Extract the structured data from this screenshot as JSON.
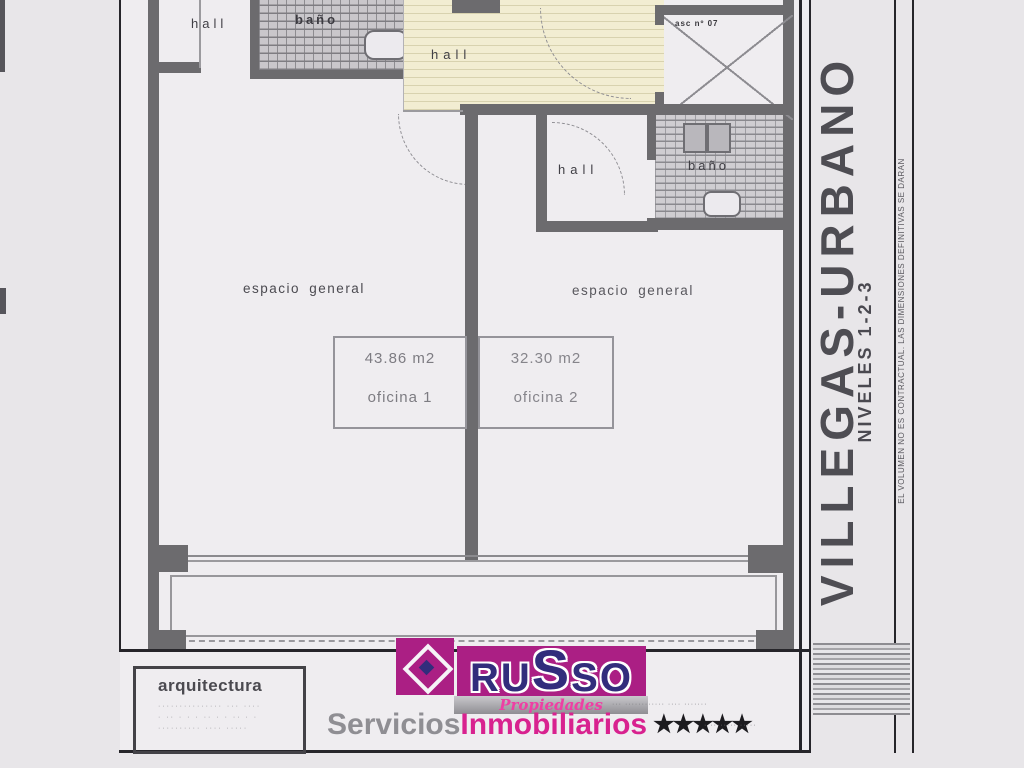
{
  "plan": {
    "labels": {
      "hall_top_left": "hall",
      "bath_top": "baño",
      "hall_main": "hall",
      "elevator": "asc nº 07",
      "hall_mid": "hall",
      "bath_mid": "baño",
      "space_left": "espacio general",
      "space_right": "espacio general"
    },
    "offices": [
      {
        "area": "43.86 m2",
        "name": "oficina 1"
      },
      {
        "area": "32.30 m2",
        "name": "oficina 2"
      }
    ]
  },
  "sidebar": {
    "title": "VILLEGAS-URBANO",
    "levels": "NIVELES 1-2-3",
    "disclaimer": "EL VOLUMEN NO ES CONTRACTUAL.  LAS DIMENSIONES DEFINITIVAS SE DARAN"
  },
  "footer": {
    "architecture": {
      "title": "arquitectura",
      "line1": "··············· ··· ····",
      "line2": "· ·· · · · ·· · · ·· · ·",
      "line3": "·········· ···· ·····"
    },
    "russo": {
      "brand": "RUSSO",
      "tagline": "Propiedades",
      "services_gray": "Servicios",
      "services_pink": "Inmobiliarios",
      "stars": "★★★★★",
      "fine_print_top": "··· ············ ···· ·······",
      "fine_print_side": "· ········ ·····"
    }
  },
  "colors": {
    "magenta": "#ab1f84",
    "navy": "#322d7c",
    "pink": "#d8228f"
  }
}
